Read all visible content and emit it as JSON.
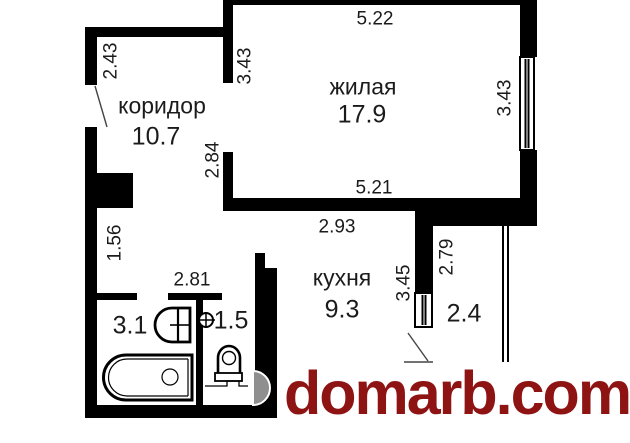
{
  "plan": {
    "rooms": {
      "corridor": {
        "label": "коридор",
        "area": "10.7"
      },
      "living": {
        "label": "жилая",
        "area": "17.9"
      },
      "kitchen": {
        "label": "кухня",
        "area": "9.3"
      },
      "bathroom": {
        "area": "3.1"
      },
      "wc": {
        "area": "1.5"
      },
      "balcony": {
        "area": "2.4"
      }
    },
    "dimensions": {
      "living_top_width": "5.22",
      "living_bottom_width": "5.21",
      "living_left_height": "3.43",
      "living_right_height": "3.43",
      "corridor_top_height": "2.43",
      "corridor_lower_height": "2.84",
      "hall_height": "1.56",
      "bath_width": "2.81",
      "kitchen_top_width": "2.93",
      "kitchen_right_height": "3.45",
      "balcony_wall_height": "2.79"
    }
  },
  "watermark": {
    "text": "domarb.com",
    "color": "#8e1313"
  },
  "colors": {
    "wall": "#000000",
    "line": "#1b1b1b",
    "door_arc": "#8f8f8f"
  }
}
